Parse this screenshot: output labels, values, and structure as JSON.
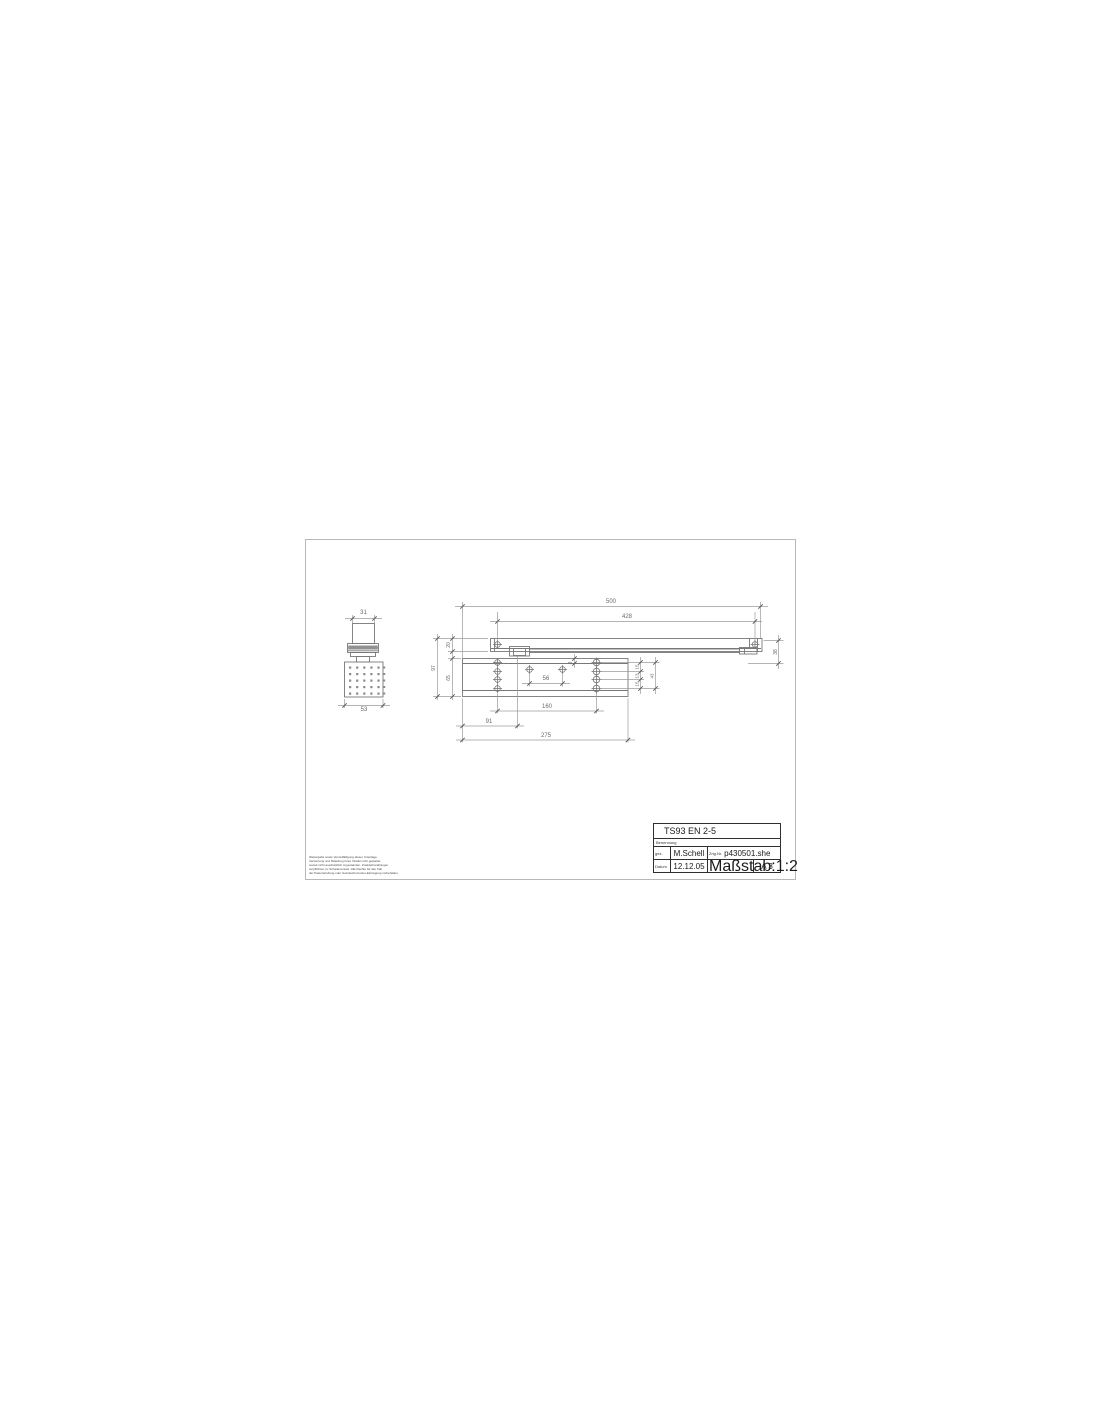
{
  "title_block": {
    "title": "TS93 EN 2-5",
    "name_label": "Benennung",
    "drawn_label": "gez.",
    "drawn_by": "M.Schell",
    "drawing_no_label": "Zng.Nr.",
    "drawing_no": "p430501.she",
    "date_label": "Datum",
    "date": "12.12.05",
    "scale_label": "Maßstab:",
    "scale": "1:2",
    "sheet_format": "A 3"
  },
  "disclaimer": {
    "lines": [
      "Weitergabe sowie Vervielfältigung dieser Unterlage,",
      "Verwertung und Mitteilung ihres Inhalts nicht gestattet,",
      "soweit nicht ausdrücklich zugestanden. Zuwiderhandlungen",
      "verpflichten zu Schadenersatz. Alle Rechte für den Fall",
      "der Patenterteilung oder Gebrauchsmuster-Eintragung vorbehalten."
    ]
  },
  "dims": {
    "side": {
      "width_top": "31",
      "width_bottom": "53"
    },
    "main": {
      "overall_length": "500",
      "rail_hole_span": "428",
      "rail_height": "20",
      "plate_height": "65",
      "total_height": "97",
      "body_offset": "8",
      "mid_hole_span": "56",
      "row_top": "15",
      "row_mid": "13",
      "row_bottom": "15",
      "rows_total": "43",
      "rail_drop": "38",
      "hole_span": "160",
      "axis_offset": "91",
      "plate_length": "275"
    }
  },
  "colors": {
    "object_line": "#787878",
    "dim_line": "#9b9b9b",
    "frame": "#b8b8b8",
    "band_fill": "#919191",
    "text": "#6b6b6b"
  }
}
